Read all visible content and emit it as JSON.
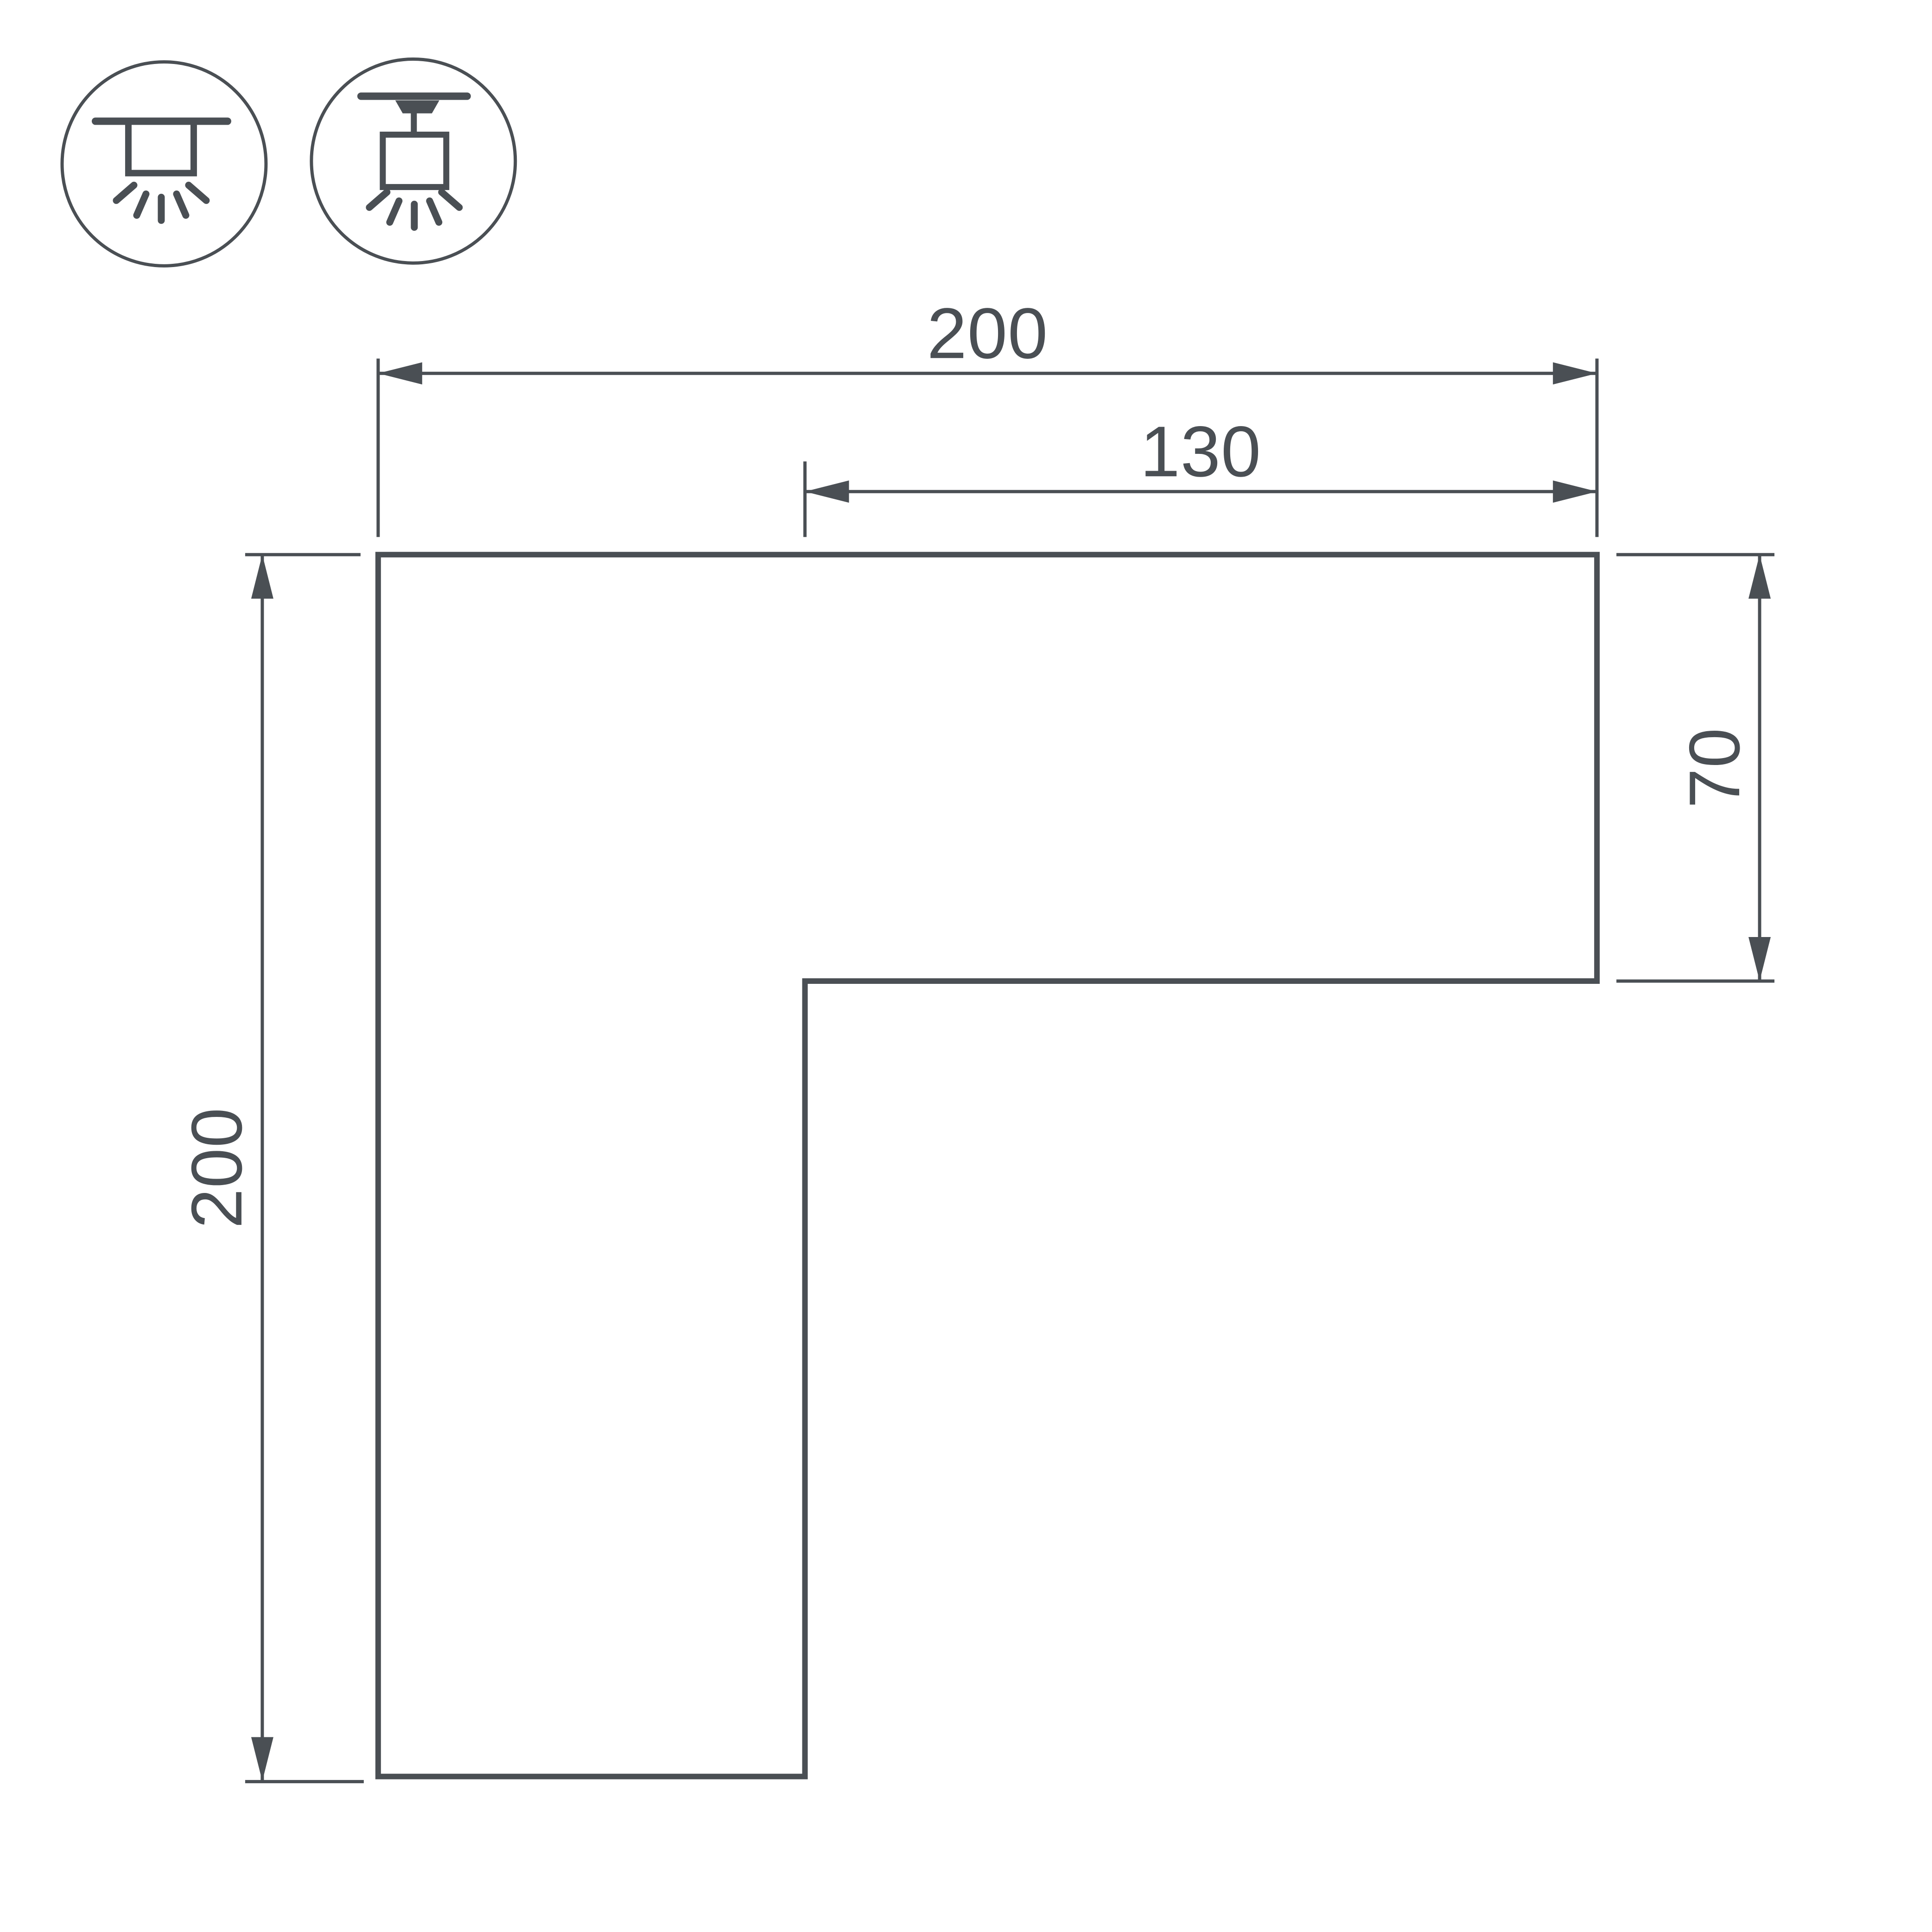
{
  "title": "corner-profile-dimension-drawing",
  "colors": {
    "line": "#4a4f54",
    "background": "#ffffff"
  },
  "dimensions": {
    "top_width": "200",
    "inner_width": "130",
    "right_height": "70",
    "left_height": "200"
  },
  "icons": [
    {
      "name": "surface-mount-ceiling-light-icon"
    },
    {
      "name": "track-pendant-light-icon"
    }
  ]
}
